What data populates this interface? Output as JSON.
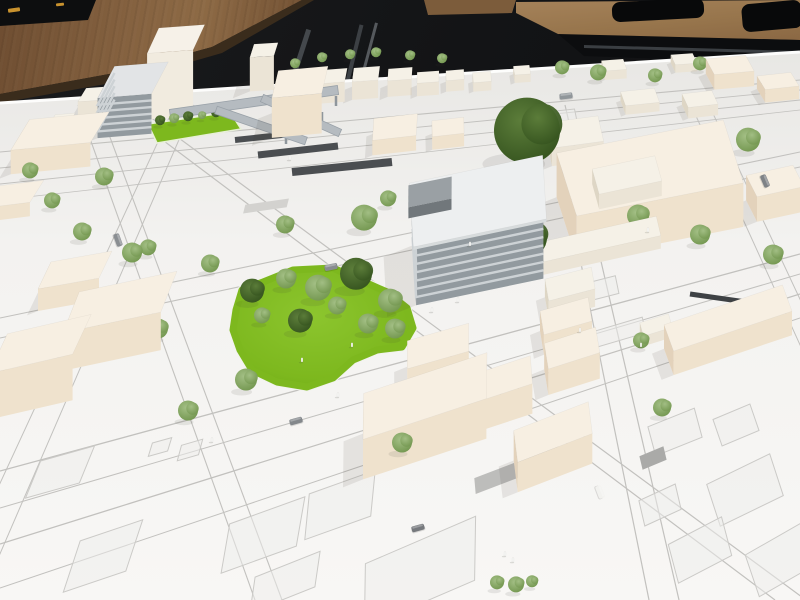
{
  "scene": {
    "description": "Photograph of a white architectural scale model of a city district on a table, with a gray striped office building, a green park with miniature trees, cream foam massing blocks, drawn streets, and wooden classroom tables in a dark room behind."
  },
  "palette": {
    "room_dark": "#141517",
    "wood_left": "#84613f",
    "wood_right": "#a5825a",
    "board_top": "#e8e7e4",
    "board_mid": "#f3f2f0",
    "board_near": "#f8f7f5",
    "board_edge_highlight": "#fdfdfc",
    "street_line": "#c2c1be",
    "parcel_line": "#cbcac7",
    "parcel_fill": "#eeedeb",
    "grass_main": "#7db81e",
    "grass_light": "#8cc52e",
    "grass_deep": "#6da815",
    "rail_platform": "#4b4e51",
    "tram_strip": "#3e4144",
    "ramp_gray": "#b5bbc0",
    "ramp_edge": "#99a1a8",
    "shadow": "rgba(70,60,45,0.10)",
    "tree_trunk": "#7a5f40",
    "person_white": "#fafaf8"
  },
  "block_palettes": {
    "cream": {
      "t": "#f7efe2",
      "l": "#e3d2bb",
      "r": "#efe2cd"
    },
    "cream2": {
      "t": "#f5f1e7",
      "l": "#ded6c5",
      "r": "#ebe4d6"
    },
    "tower": {
      "t": "#f6f1e8",
      "l": "#e6ddd0",
      "r": "#f1ebdf"
    },
    "gray": {
      "t": "#e2e4e6",
      "l": "#7f868b",
      "r": "#929a9f",
      "s": "#cdd2d5"
    },
    "grayDark": {
      "t": "#9aa0a4",
      "l": "#62686c",
      "r": "#71777b"
    },
    "roof": {
      "t": "#edeff0",
      "l": "#c5c9cb",
      "r": "#d7dbdc"
    }
  },
  "projection": {
    "vp_u": [
      1780,
      -12
    ],
    "vp_v": [
      436,
      -457
    ]
  },
  "board": {
    "poly": [
      [
        0,
        103
      ],
      [
        800,
        52
      ],
      [
        800,
        600
      ],
      [
        0,
        600
      ]
    ]
  },
  "streets": [
    [
      0,
      152,
      800,
      80,
      1.1
    ],
    [
      0,
      168,
      800,
      90,
      0.9
    ],
    [
      0,
      184,
      800,
      100,
      0.9
    ],
    [
      0,
      200,
      800,
      110,
      0.8
    ],
    [
      0,
      318,
      800,
      152,
      1.1
    ],
    [
      0,
      338,
      800,
      167,
      1.1
    ],
    [
      0,
      471,
      800,
      254,
      1.3
    ],
    [
      0,
      508,
      800,
      274,
      1.0
    ],
    [
      0,
      544,
      800,
      294,
      1.3
    ],
    [
      0,
      588,
      800,
      318,
      1.0
    ],
    [
      549,
      105,
      649,
      600,
      1.2
    ],
    [
      565,
      105,
      679,
      600,
      1.2
    ],
    [
      691,
      105,
      916,
      600,
      1.0
    ],
    [
      709,
      105,
      941,
      600,
      1.0
    ],
    [
      175,
      105,
      -54,
      600,
      1.0
    ],
    [
      194,
      105,
      -20,
      600,
      1.0
    ],
    [
      78,
      105,
      255,
      600,
      1.1
    ],
    [
      98,
      105,
      282,
      600,
      1.1
    ],
    [
      116,
      105,
      775,
      600,
      1.2
    ],
    [
      134,
      105,
      806,
      600,
      1.2
    ]
  ],
  "parcels": [
    [
      60,
      472,
      56,
      40
    ],
    [
      103,
      556,
      66,
      54
    ],
    [
      263,
      535,
      80,
      50
    ],
    [
      285,
      582,
      70,
      36
    ],
    [
      190,
      450,
      22,
      16
    ],
    [
      160,
      447,
      20,
      14
    ],
    [
      420,
      572,
      120,
      64
    ],
    [
      340,
      505,
      70,
      46
    ],
    [
      736,
      425,
      40,
      28
    ],
    [
      675,
      432,
      50,
      30
    ],
    [
      745,
      490,
      70,
      44
    ],
    [
      700,
      550,
      60,
      40
    ],
    [
      780,
      560,
      64,
      44
    ],
    [
      660,
      505,
      40,
      26
    ],
    [
      567,
      254,
      56,
      18
    ],
    [
      588,
      292,
      60,
      18
    ],
    [
      620,
      332,
      50,
      16
    ],
    [
      556,
      118,
      40,
      14
    ]
  ],
  "pads": [
    [
      517,
      470,
      90,
      16,
      "#bdbdbb"
    ],
    [
      653,
      458,
      26,
      14,
      "#aaaaa8"
    ],
    [
      266,
      206,
      44,
      9,
      "#d3d2cf"
    ]
  ],
  "platforms": [
    [
      235,
      140,
      300,
      133,
      6,
      "#4b4e51"
    ],
    [
      258,
      155,
      338,
      146,
      7,
      "#4b4e51"
    ],
    [
      292,
      172,
      392,
      162,
      8,
      "#4b4e51"
    ],
    [
      690,
      294,
      788,
      308,
      5,
      "#3e4144"
    ]
  ],
  "park": {
    "points": [
      [
        242,
        290
      ],
      [
        263,
        282
      ],
      [
        293,
        270
      ],
      [
        333,
        268
      ],
      [
        360,
        280
      ],
      [
        387,
        292
      ],
      [
        407,
        308
      ],
      [
        413,
        328
      ],
      [
        402,
        347
      ],
      [
        377,
        350
      ],
      [
        353,
        360
      ],
      [
        333,
        378
      ],
      [
        307,
        387
      ],
      [
        277,
        382
      ],
      [
        252,
        370
      ],
      [
        240,
        350
      ],
      [
        233,
        330
      ],
      [
        236,
        310
      ]
    ]
  },
  "courtyard": {
    "points": [
      [
        148,
        124
      ],
      [
        230,
        112
      ],
      [
        241,
        129
      ],
      [
        157,
        143
      ]
    ]
  },
  "ramps": [
    [
      170,
      114,
      338,
      90,
      9
    ],
    [
      216,
      110,
      306,
      141,
      8
    ],
    [
      262,
      98,
      340,
      133,
      8
    ]
  ],
  "ramp_legs": [
    [
      296,
      104,
      296,
      118
    ],
    [
      322,
      112,
      322,
      126
    ],
    [
      286,
      134,
      286,
      144
    ],
    [
      336,
      96,
      336,
      106
    ]
  ],
  "buildings": [
    {
      "name": "white-tower",
      "x": 176,
      "y": 105,
      "w": 46,
      "d": 28,
      "h": 66,
      "pal": "tower"
    },
    {
      "name": "gray-slab-building",
      "x": 133,
      "y": 120,
      "w": 54,
      "d": 36,
      "h": 40,
      "pal": "gray",
      "stripes": 5
    },
    {
      "name": "small-block",
      "x": 95,
      "y": 108,
      "w": 26,
      "d": 16,
      "h": 14,
      "pal": "cream2"
    },
    {
      "name": "small-block",
      "x": 62,
      "y": 128,
      "w": 20,
      "d": 12,
      "h": 9,
      "pal": "cream2"
    },
    {
      "name": "left-block",
      "x": 60,
      "y": 155,
      "w": 80,
      "d": 36,
      "h": 24,
      "pal": "cream"
    },
    {
      "name": "left-block",
      "x": 15,
      "y": 208,
      "w": 44,
      "d": 26,
      "h": 14,
      "pal": "cream"
    },
    {
      "name": "left-block",
      "x": 75,
      "y": 292,
      "w": 62,
      "d": 30,
      "h": 22,
      "pal": "cream"
    },
    {
      "name": "left-block",
      "x": 120,
      "y": 340,
      "w": 100,
      "d": 44,
      "h": 38,
      "pal": "cream"
    },
    {
      "name": "left-block",
      "x": 40,
      "y": 390,
      "w": 86,
      "d": 44,
      "h": 46,
      "pal": "cream"
    },
    {
      "name": "top-tower",
      "x": 264,
      "y": 84,
      "w": 24,
      "d": 14,
      "h": 34,
      "pal": "cream2"
    },
    {
      "name": "top-big-block",
      "x": 300,
      "y": 122,
      "w": 50,
      "d": 28,
      "h": 40,
      "pal": "cream"
    },
    {
      "name": "top-row-block",
      "x": 332,
      "y": 96,
      "w": 28,
      "d": 14,
      "h": 20,
      "pal": "cream2"
    },
    {
      "name": "top-row-block",
      "x": 366,
      "y": 92,
      "w": 26,
      "d": 14,
      "h": 18,
      "pal": "cream2"
    },
    {
      "name": "top-row-block",
      "x": 400,
      "y": 90,
      "w": 24,
      "d": 12,
      "h": 16,
      "pal": "cream2"
    },
    {
      "name": "top-row-block",
      "x": 428,
      "y": 90,
      "w": 22,
      "d": 11,
      "h": 13,
      "pal": "cream2"
    },
    {
      "name": "top-row-block",
      "x": 455,
      "y": 86,
      "w": 18,
      "d": 10,
      "h": 11,
      "pal": "cream2"
    },
    {
      "name": "top-row-block",
      "x": 482,
      "y": 86,
      "w": 18,
      "d": 10,
      "h": 9,
      "pal": "cream2"
    },
    {
      "name": "top-row-block",
      "x": 522,
      "y": 78,
      "w": 16,
      "d": 9,
      "h": 8,
      "pal": "cream2"
    },
    {
      "name": "top-row-block",
      "x": 614,
      "y": 74,
      "w": 22,
      "d": 11,
      "h": 9,
      "pal": "cream2"
    },
    {
      "name": "top-row-block",
      "x": 684,
      "y": 67,
      "w": 22,
      "d": 11,
      "h": 8,
      "pal": "cream2"
    },
    {
      "name": "top-right-block",
      "x": 730,
      "y": 80,
      "w": 40,
      "d": 18,
      "h": 15,
      "pal": "cream"
    },
    {
      "name": "top-right-block",
      "x": 778,
      "y": 94,
      "w": 34,
      "d": 16,
      "h": 13,
      "pal": "cream"
    },
    {
      "name": "small-block",
      "x": 700,
      "y": 110,
      "w": 30,
      "d": 15,
      "h": 11,
      "pal": "cream2"
    },
    {
      "name": "small-block",
      "x": 640,
      "y": 106,
      "w": 34,
      "d": 15,
      "h": 9,
      "pal": "cream2"
    },
    {
      "name": "mid-block",
      "x": 395,
      "y": 142,
      "w": 44,
      "d": 22,
      "h": 15,
      "pal": "cream"
    },
    {
      "name": "mid-block",
      "x": 448,
      "y": 140,
      "w": 32,
      "d": 16,
      "h": 13,
      "pal": "cream"
    },
    {
      "name": "office-building",
      "x": 478,
      "y": 262,
      "w": 130,
      "d": 60,
      "h": 58,
      "pal": "gray",
      "stripes": 6
    },
    {
      "name": "office-roof-slab",
      "x": 478,
      "y": 262,
      "w": 136,
      "d": 64,
      "h": 3,
      "z": 58,
      "pal": "roof",
      "noshadow": true
    },
    {
      "name": "office-rooftop-box",
      "x": 430,
      "y": 264,
      "w": 44,
      "d": 22,
      "h": 11,
      "z": 61,
      "pal": "grayDark",
      "noshadow": true
    },
    {
      "name": "right-complex-wing",
      "x": 575,
      "y": 150,
      "w": 52,
      "d": 26,
      "h": 18,
      "pal": "cream2"
    },
    {
      "name": "right-complex-main",
      "x": 650,
      "y": 212,
      "w": 170,
      "d": 66,
      "h": 44,
      "pal": "cream"
    },
    {
      "name": "right-complex-rooftop",
      "x": 627,
      "y": 234,
      "w": 64,
      "d": 26,
      "h": 15,
      "z": 44,
      "pal": "cream2",
      "noshadow": true
    },
    {
      "name": "right-low-wing",
      "x": 600,
      "y": 252,
      "w": 120,
      "d": 20,
      "h": 13,
      "pal": "cream2"
    },
    {
      "name": "column-block",
      "x": 570,
      "y": 302,
      "w": 48,
      "d": 22,
      "h": 18,
      "pal": "cream2"
    },
    {
      "name": "column-block",
      "x": 566,
      "y": 336,
      "w": 50,
      "d": 24,
      "h": 20,
      "pal": "cream"
    },
    {
      "name": "column-block",
      "x": 572,
      "y": 374,
      "w": 54,
      "d": 26,
      "h": 26,
      "pal": "cream"
    },
    {
      "name": "right-edge-slab",
      "x": 775,
      "y": 206,
      "w": 48,
      "d": 24,
      "h": 25,
      "pal": "cream"
    },
    {
      "name": "long-bar-building",
      "x": 728,
      "y": 342,
      "w": 125,
      "d": 28,
      "h": 24,
      "pal": "cream"
    },
    {
      "name": "small-block",
      "x": 656,
      "y": 335,
      "w": 30,
      "d": 14,
      "h": 10,
      "pal": "cream2"
    },
    {
      "name": "south-block-long",
      "x": 425,
      "y": 436,
      "w": 130,
      "d": 46,
      "h": 40,
      "pal": "cream"
    },
    {
      "name": "south-block",
      "x": 438,
      "y": 372,
      "w": 64,
      "d": 28,
      "h": 26,
      "pal": "cream"
    },
    {
      "name": "south-block",
      "x": 500,
      "y": 410,
      "w": 66,
      "d": 28,
      "h": 30,
      "pal": "cream"
    },
    {
      "name": "south-block",
      "x": 553,
      "y": 462,
      "w": 80,
      "d": 32,
      "h": 30,
      "pal": "cream"
    }
  ],
  "trees": [
    [
      527,
      162,
      33,
      "dark"
    ],
    [
      528,
      256,
      19,
      "dark"
    ],
    [
      364,
      230,
      13,
      "light"
    ],
    [
      388,
      206,
      8,
      "light"
    ],
    [
      252,
      302,
      12,
      "dark"
    ],
    [
      286,
      288,
      10,
      "light"
    ],
    [
      318,
      300,
      13,
      "light"
    ],
    [
      356,
      289,
      16,
      "dark"
    ],
    [
      390,
      312,
      12,
      "light"
    ],
    [
      368,
      333,
      10,
      "light"
    ],
    [
      300,
      332,
      12,
      "dark"
    ],
    [
      262,
      323,
      8,
      "light"
    ],
    [
      395,
      338,
      10,
      "light"
    ],
    [
      337,
      314,
      9,
      "light"
    ],
    [
      246,
      390,
      11,
      "light"
    ],
    [
      402,
      452,
      10,
      "light"
    ],
    [
      104,
      185,
      9,
      "light"
    ],
    [
      132,
      262,
      10,
      "light"
    ],
    [
      158,
      338,
      10,
      "light"
    ],
    [
      188,
      420,
      10,
      "light"
    ],
    [
      30,
      178,
      8,
      "light"
    ],
    [
      52,
      208,
      8,
      "light"
    ],
    [
      82,
      240,
      9,
      "light"
    ],
    [
      210,
      272,
      9,
      "light"
    ],
    [
      148,
      255,
      8,
      "light"
    ],
    [
      295,
      68,
      5,
      "light"
    ],
    [
      322,
      62,
      5,
      "light"
    ],
    [
      350,
      59,
      5,
      "light"
    ],
    [
      376,
      57,
      5,
      "light"
    ],
    [
      410,
      60,
      5,
      "light"
    ],
    [
      442,
      63,
      5,
      "light"
    ],
    [
      160,
      125,
      5,
      "dark"
    ],
    [
      174,
      123,
      5,
      "light"
    ],
    [
      188,
      121,
      5,
      "dark"
    ],
    [
      202,
      119,
      4,
      "light"
    ],
    [
      216,
      117,
      5,
      "dark"
    ],
    [
      142,
      113,
      4,
      "light"
    ],
    [
      605,
      164,
      9,
      "light"
    ],
    [
      612,
      192,
      8,
      "light"
    ],
    [
      638,
      226,
      11,
      "light"
    ],
    [
      700,
      244,
      10,
      "light"
    ],
    [
      748,
      151,
      12,
      "light"
    ],
    [
      773,
      264,
      10,
      "light"
    ],
    [
      662,
      416,
      9,
      "light"
    ],
    [
      641,
      348,
      8,
      "light"
    ],
    [
      562,
      74,
      7,
      "light"
    ],
    [
      598,
      80,
      8,
      "light"
    ],
    [
      655,
      82,
      7,
      "light"
    ],
    [
      700,
      70,
      7,
      "light"
    ],
    [
      285,
      233,
      9,
      "light"
    ],
    [
      497,
      589,
      7,
      "light"
    ],
    [
      516,
      592,
      8,
      "light"
    ],
    [
      532,
      587,
      6,
      "light"
    ]
  ],
  "cars": [
    [
      296,
      421,
      -16,
      "#83878b"
    ],
    [
      418,
      528,
      -16,
      "#76797d"
    ],
    [
      331,
      267,
      -12,
      "#888c90"
    ],
    [
      765,
      181,
      67,
      "#7e8286"
    ],
    [
      118,
      240,
      70,
      "#8a8e92"
    ],
    [
      600,
      492,
      69,
      "#f2f2ef"
    ],
    [
      566,
      96,
      -7,
      "#90969a"
    ]
  ],
  "people": [
    [
      432,
      312
    ],
    [
      458,
      302
    ],
    [
      352,
      347
    ],
    [
      302,
      362
    ],
    [
      212,
      442
    ],
    [
      505,
      556
    ],
    [
      513,
      562
    ],
    [
      641,
      347
    ],
    [
      580,
      332
    ],
    [
      338,
      397
    ],
    [
      648,
      232
    ],
    [
      470,
      246
    ],
    [
      290,
      160
    ]
  ]
}
